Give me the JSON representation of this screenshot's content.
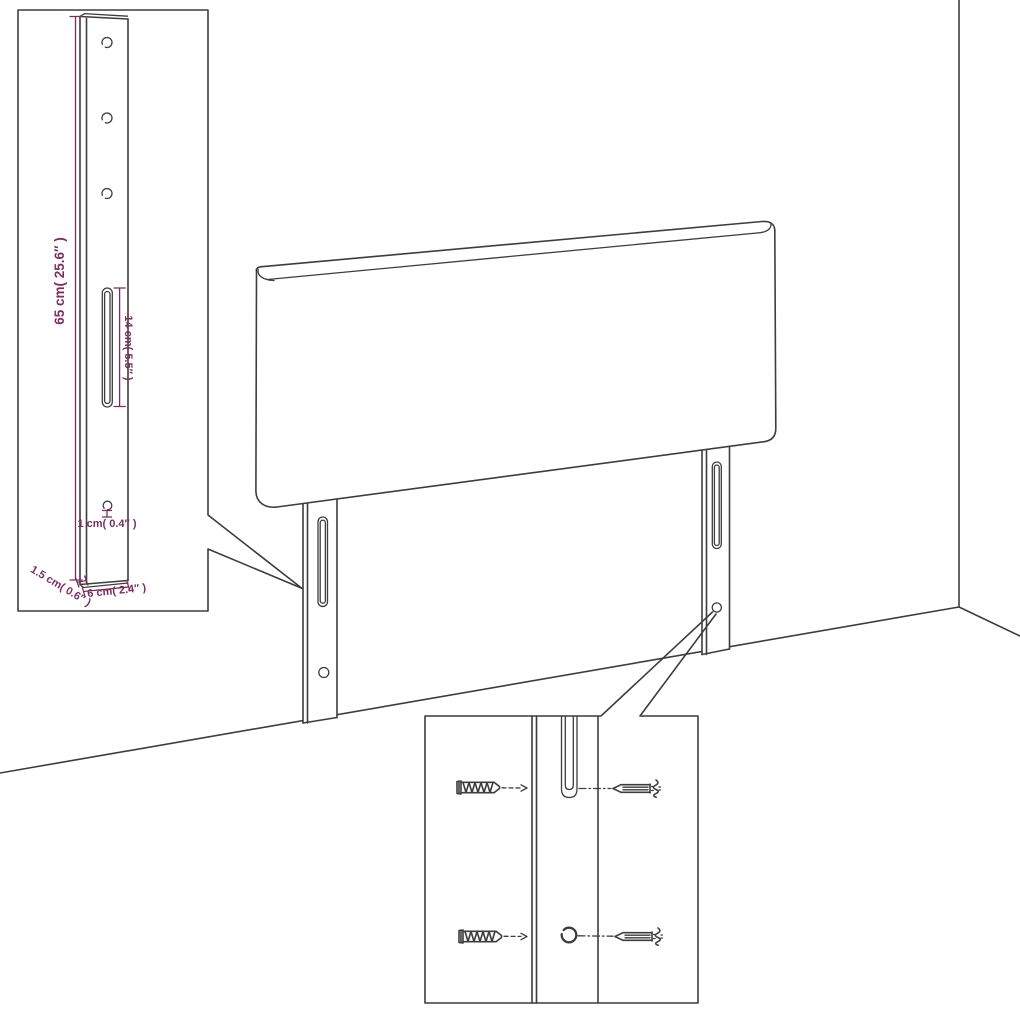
{
  "diagram": {
    "title": "Headboard with mounting legs — assembly dimension diagram",
    "colors": {
      "line": "#3d3d3d",
      "dimension": "#7b2e5e",
      "background": "#ffffff"
    },
    "leg_detail_inset": {
      "height_label": "65 cm( 25.6″ )",
      "slot_label": "14 cm( 5.5″ )",
      "hole_label": "1 cm( 0.4″ )",
      "thickness_label": "1.5 cm( 0.6″ )",
      "width_label": "6 cm( 2.4″ )"
    },
    "mounting_detail_inset": {
      "parts": [
        {
          "name": "wood-screw",
          "count": 2
        },
        {
          "name": "wall-anchor",
          "count": 2
        }
      ],
      "features": [
        "keyhole-slot",
        "round-hole"
      ]
    }
  }
}
